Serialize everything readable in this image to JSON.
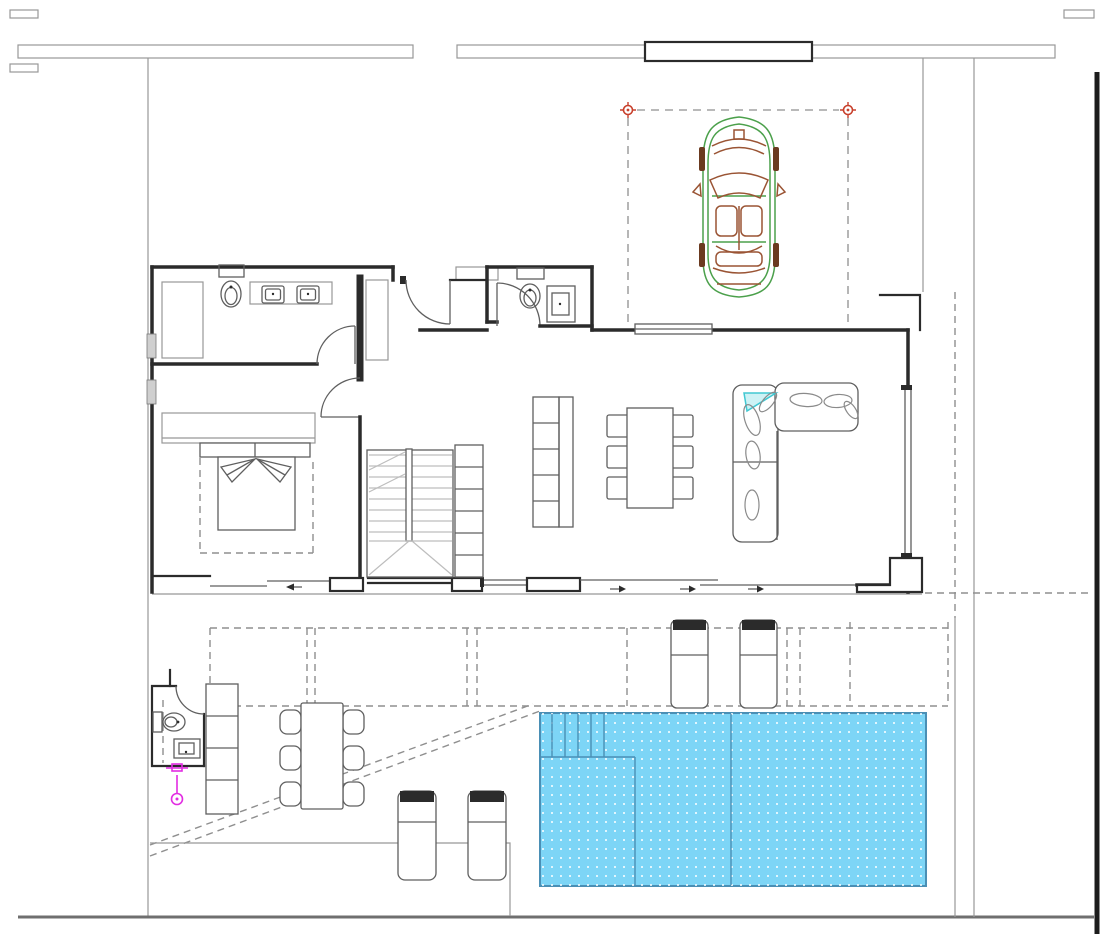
{
  "colors": {
    "background": "#ffffff",
    "wall": "#2b2b2b",
    "line": "#5f5f5f",
    "light_line": "#989898",
    "stair_line": "#bdbdbd",
    "dashed_line": "#8f8f8f",
    "window_fill": "#cfcfcf",
    "pool_fill": "#7dd5f6",
    "pool_border": "#4a8fb5",
    "pool_dot": "#ffffff",
    "car_green": "#4ba04b",
    "car_brown": "#9a5434",
    "car_dark": "#6b3a20",
    "marker_red": "#c8402c",
    "shower_magenta": "#e22ce2",
    "sofa_accent": "#41c8d2",
    "sofa_accent_fill": "#cdf2f5"
  },
  "inventory": {
    "indoor_rooms": [
      "bathroom",
      "guest-wc",
      "entry-hall",
      "bedroom",
      "stair-hall",
      "kitchen-dining",
      "living-room"
    ],
    "outdoor_areas": [
      "parking-space",
      "driveway",
      "terrace",
      "pergola-zone",
      "outdoor-wc",
      "swimming-pool"
    ],
    "furniture_counts": {
      "cars": 1,
      "beds": 1,
      "sofas": 1,
      "dining_chairs": 6,
      "outdoor_chairs": 6,
      "sun_loungers": 4,
      "toilets": 3,
      "sinks": 4,
      "showers": 1,
      "storage_columns": 3,
      "staircases": 1
    }
  }
}
